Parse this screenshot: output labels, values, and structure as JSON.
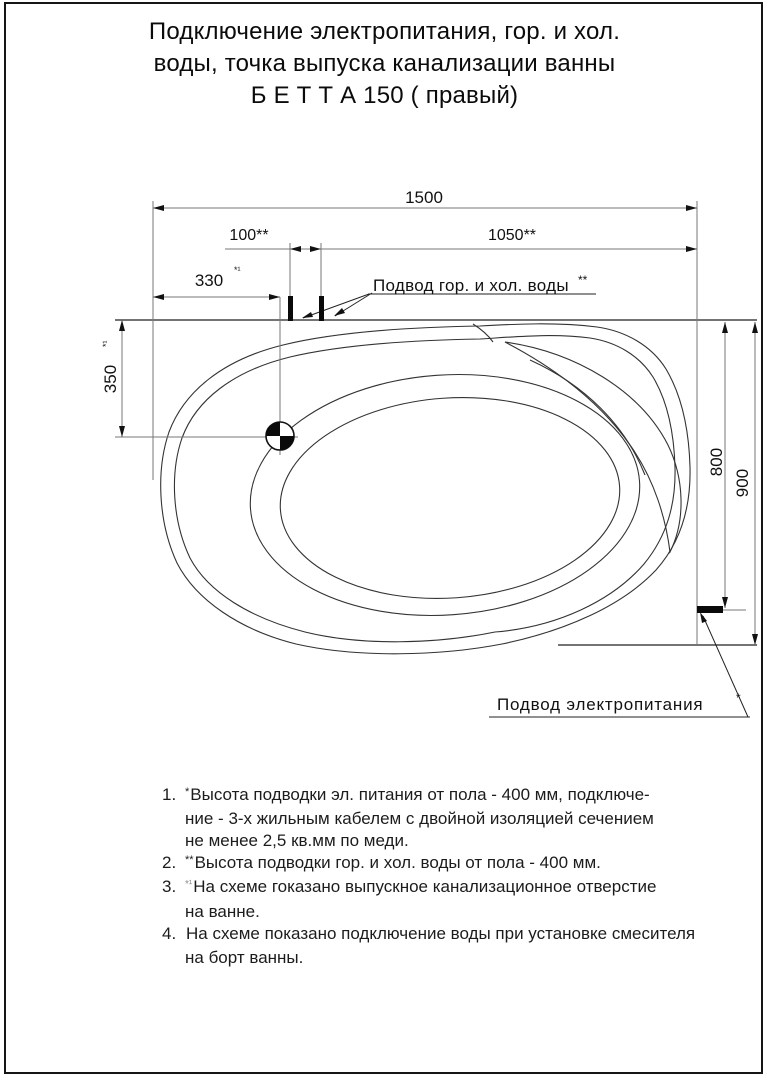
{
  "title": {
    "line1": "Подключение электропитания, гор. и хол.",
    "line2": "воды, точка выпуска канализации ванны",
    "line3": "Б Е Т Т А 150  ( правый)"
  },
  "drawing": {
    "dim_width_total": "1500",
    "dim_water_spacing": "100**",
    "dim_water_to_right": "1050**",
    "dim_drain_from_left": "330",
    "dim_drain_from_left_tol": "*¹",
    "dim_drain_from_top": "350",
    "dim_drain_from_top_tol": "*¹",
    "dim_power_from_top": "800",
    "dim_depth_total": "900",
    "label_water_supply": "Подвод гор. и хол. воды",
    "label_water_supply_sup": "**",
    "label_power_supply": "Подвод электропитания",
    "label_power_supply_sup": "*"
  },
  "notes": [
    {
      "num": "1.",
      "sup": "*",
      "lines": [
        "Высота подводки эл. питания от пола - 400 мм, подключе-",
        "ние - 3-х жильным кабелем с двойной изоляцией сечением",
        "не менее 2,5 кв.мм по меди."
      ]
    },
    {
      "num": "2.",
      "sup": "**",
      "lines": [
        "Высота подводки гор. и хол. воды от пола - 400 мм.",
        "",
        ""
      ]
    },
    {
      "num": "3.",
      "sup": "*¹",
      "lines": [
        "На схеме гоказано выпускное канализационное отверстие",
        "на ванне.",
        ""
      ]
    },
    {
      "num": "4.",
      "sup": "",
      "lines": [
        "На схеме показано подключение воды при установке смесителя",
        "на борт ванны.",
        ""
      ]
    }
  ]
}
